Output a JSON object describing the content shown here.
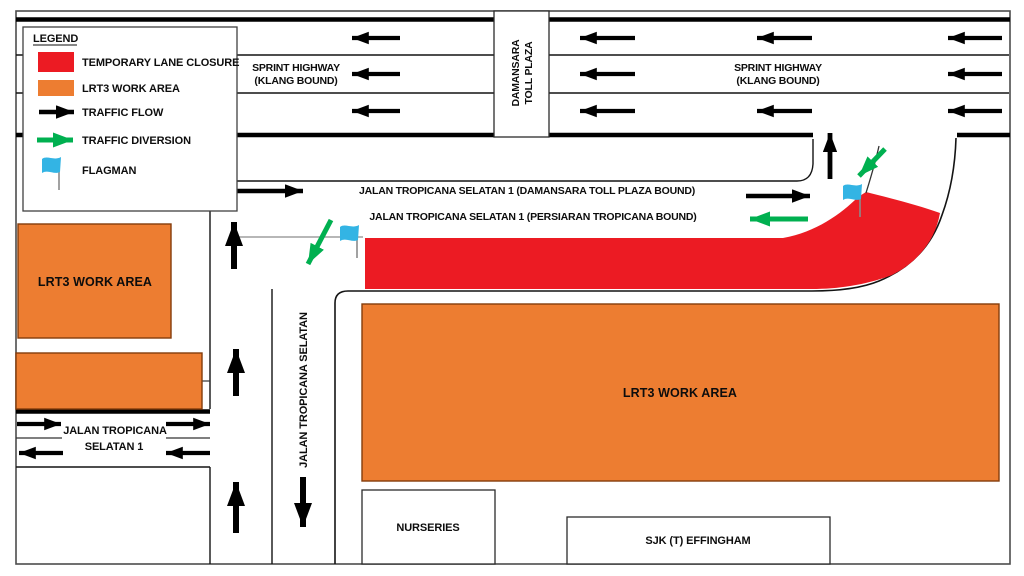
{
  "colors": {
    "closure_red": "#EC1B23",
    "work_orange": "#ED7D31",
    "diversion_green": "#00B050",
    "flag_blue": "#33B4E4",
    "road_black": "#000000"
  },
  "legend": {
    "title": "LEGEND",
    "item1": "TEMPORARY LANE CLOSURE",
    "item2": "LRT3 WORK AREA",
    "item3": "TRAFFIC FLOW",
    "item4": "TRAFFIC DIVERSION",
    "item5": "FLAGMAN"
  },
  "highway": {
    "name1": "SPRINT HIGHWAY",
    "name2": "(KLANG BOUND)",
    "toll1": "DAMANSARA",
    "toll2": "TOLL PLAZA"
  },
  "streets": {
    "damansara_bound": "JALAN TROPICANA SELATAN 1 (DAMANSARA TOLL PLAZA BOUND)",
    "persiaran_bound": "JALAN TROPICANA SELATAN 1 (PERSIARAN TROPICANA BOUND)",
    "selatan_vertical": "JALAN TROPICANA SELATAN",
    "west1": "JALAN TROPICANA",
    "west2": "SELATAN 1"
  },
  "areas": {
    "work_left": "LRT3 WORK AREA",
    "work_main": "LRT3 WORK AREA"
  },
  "buildings": {
    "nurseries": "NURSERIES",
    "school": "SJK (T) EFFINGHAM"
  }
}
